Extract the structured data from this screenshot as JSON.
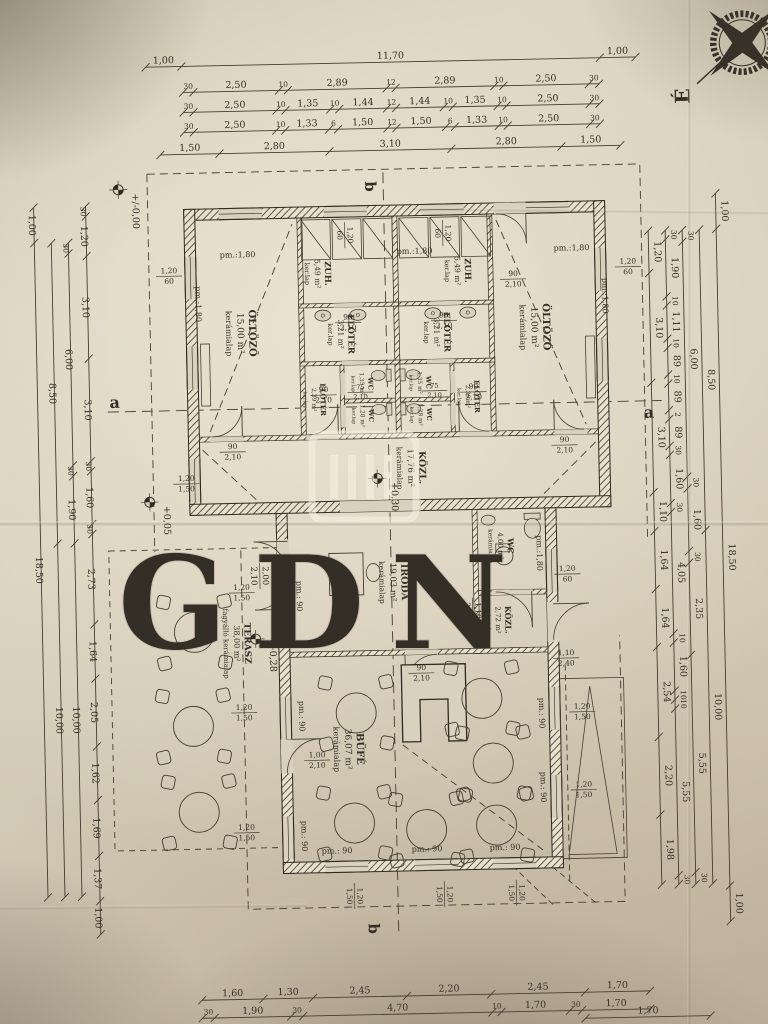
{
  "compass": {
    "label": "É"
  },
  "watermark": {
    "text": "GDN"
  },
  "sections": {
    "a": "a",
    "b": "b"
  },
  "levels": [
    {
      "id": "datum",
      "value": "+/-0,00"
    },
    {
      "id": "entry",
      "value": "+0,05"
    },
    {
      "id": "kozl",
      "value": "+0,30"
    },
    {
      "id": "iroda",
      "value": "+0,30"
    },
    {
      "id": "terasz",
      "value": "+0,28"
    }
  ],
  "rooms": [
    {
      "id": "oltozo-left",
      "name": "ÖLTÖZŐ",
      "area": "15,00 m²",
      "floor": "kerámialap"
    },
    {
      "id": "zuh-left",
      "name": "ZUH.",
      "area": "5,49 m²",
      "floor": "ker.lap"
    },
    {
      "id": "eloter-left-felso",
      "name": "ELŐTÉR",
      "area": "3,21 m²",
      "floor": "ker.lap"
    },
    {
      "id": "wc-left-1",
      "name": "WC",
      "area": "1,35 m²",
      "floor": "ker.lap"
    },
    {
      "id": "wc-left-2",
      "name": "WC",
      "area": "1,28 m²",
      "floor": "ker.lap"
    },
    {
      "id": "eloter-left-also",
      "name": "ELŐTÉR",
      "area": "2,39 m²",
      "floor": "ker.lap"
    },
    {
      "id": "zuh-right",
      "name": "ZUH.",
      "area": "5,49 m²",
      "floor": "ker.lap"
    },
    {
      "id": "eloter-right-felso",
      "name": "ELŐTÉR",
      "area": "3,21 m²",
      "floor": "ker.lap"
    },
    {
      "id": "wc-right-1",
      "name": "WC",
      "area": "1,35 m²",
      "floor": "ker.lap"
    },
    {
      "id": "wc-right-2",
      "name": "WC",
      "area": "1,28 m²",
      "floor": "ker.lap"
    },
    {
      "id": "eloter-right-also",
      "name": "ELŐTÉR",
      "area": "2,39 m²",
      "floor": "ker.lap"
    },
    {
      "id": "oltozo-right",
      "name": "ÖLTÖZŐ",
      "area": "15,00 m²",
      "floor": "kerámialap"
    },
    {
      "id": "kozl-fo",
      "name": "KÖZL.",
      "area": "17,76 m²",
      "floor": "kerámialap"
    },
    {
      "id": "iroda",
      "name": "IRODA",
      "area": "19,03 m²",
      "floor": "kerámialap"
    },
    {
      "id": "wc-akadalymentes",
      "name": "WC",
      "area": "4,00 m²",
      "floor": "kerámialap"
    },
    {
      "id": "kozl-kis",
      "name": "KÖZL.",
      "area": "2,72 m²",
      "floor": "kerámialap"
    },
    {
      "id": "bufe",
      "name": "BÜFÉ",
      "area": "36,07 m²",
      "floor": "kerámialap"
    },
    {
      "id": "terasz",
      "name": "TERASZ",
      "area": "38,00 m²",
      "floor": "fagyálló kerámialap"
    }
  ],
  "openings": {
    "door_90": {
      "w": "90",
      "h": "2,10"
    },
    "door_75": {
      "w": "75",
      "h": "2,10"
    },
    "door_entrance": {
      "w": "2,00",
      "h": "2,10"
    },
    "door_wc_akm": {
      "w": "1,10",
      "h": "2,10"
    },
    "door_kozl": {
      "w": "1,10",
      "h": "2,40"
    },
    "door_terasz": {
      "w": "1,00",
      "h": "2,10"
    },
    "window_upper": {
      "w": "1,20",
      "h": "60",
      "sill": "pm.:1,80"
    },
    "window_lower": {
      "w": "1,20",
      "h": "1,50",
      "sill": "pm.: 90"
    }
  },
  "dims": {
    "top": [
      {
        "values": [
          "1,00",
          "11,70",
          "1,00"
        ]
      },
      {
        "values": [
          "30",
          "2,50",
          "10",
          "2,89",
          "12",
          "2,89",
          "10",
          "2,50",
          "30"
        ]
      },
      {
        "values": [
          "30",
          "2,50",
          "10",
          "1,35",
          "10",
          "1,44",
          "12",
          "1,44",
          "10",
          "1,35",
          "10",
          "2,50",
          "30"
        ]
      },
      {
        "values": [
          "30",
          "2,50",
          "10",
          "1,33",
          "6",
          "1,50",
          "12",
          "1,50",
          "6",
          "1,33",
          "10",
          "2,50",
          "30"
        ]
      },
      {
        "values": [
          "1,50",
          "2,80",
          "3,10",
          "2,80",
          "1,50"
        ]
      }
    ],
    "left": [
      {
        "values": [
          "1,00",
          "18,50"
        ]
      },
      {
        "values": [
          "8,50",
          "10,00"
        ]
      },
      {
        "values": [
          "30",
          "6,00",
          "30",
          "1,90",
          "10,00"
        ]
      },
      {
        "values": [
          "30",
          "1,20",
          "3,10",
          "3,10",
          "30",
          "1,60",
          "30",
          "2,73",
          "1,64",
          "2,05",
          "1,62",
          "1,69",
          "1,37",
          "1,00"
        ]
      }
    ],
    "right": [
      {
        "values": [
          "1,20",
          "3,10",
          "3,10",
          "1,10",
          "1,64",
          "1,64",
          "2,54",
          "2,20",
          "1,98"
        ]
      },
      {
        "values": [
          "30",
          "1,90",
          "10",
          "1,11",
          "10",
          "89",
          "10",
          "89",
          "2",
          "89",
          "30",
          "1,60",
          "30",
          "4,05",
          "10",
          "1,60",
          "10",
          "10",
          "5,55",
          "30"
        ]
      },
      {
        "values": [
          "30",
          "6,00",
          "30",
          "1,60",
          "30",
          "2,35",
          "5,55",
          "30"
        ]
      },
      {
        "values": [
          "8,50",
          "10,00"
        ]
      },
      {
        "values": [
          "1,00",
          "18,50",
          "1,00"
        ]
      }
    ],
    "bottom": [
      {
        "values": [
          "1,60",
          "1,30",
          "2,45",
          "2,20",
          "2,45",
          "1,70"
        ]
      },
      {
        "values": [
          "30",
          "1,90",
          "30",
          "4,70",
          "10",
          "1,70",
          "30",
          "1,70"
        ]
      },
      {
        "values": [
          "1,70"
        ]
      }
    ]
  }
}
